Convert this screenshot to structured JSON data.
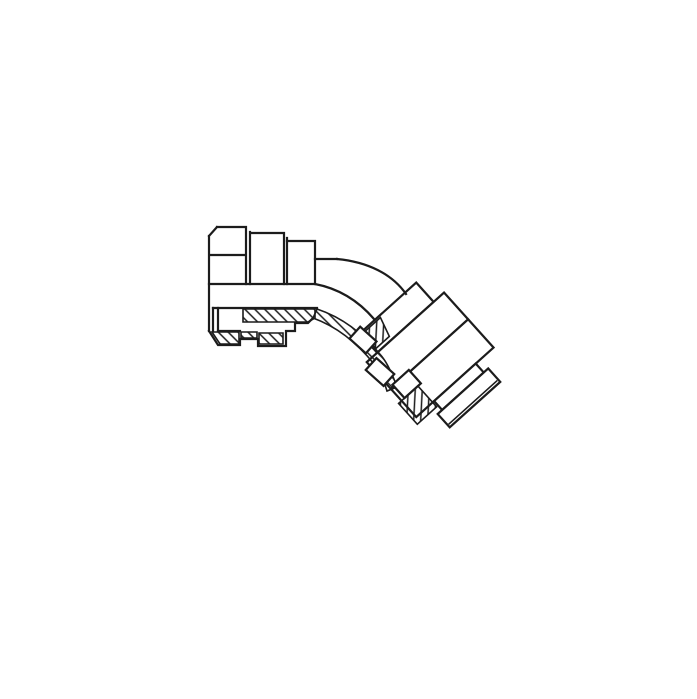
{
  "colors": {
    "background": "#ffffff",
    "line": "#1c1c1c"
  },
  "diagram": {
    "type": "technical-line-drawing",
    "subject": "45-degree female swivel elbow fitting, partial section view",
    "parts": [
      {
        "name": "left-swivel-nut"
      },
      {
        "name": "fitting-body"
      },
      {
        "name": "elbow-bend-tube"
      },
      {
        "name": "right-swivel-nut"
      },
      {
        "name": "section-hatching"
      }
    ]
  }
}
